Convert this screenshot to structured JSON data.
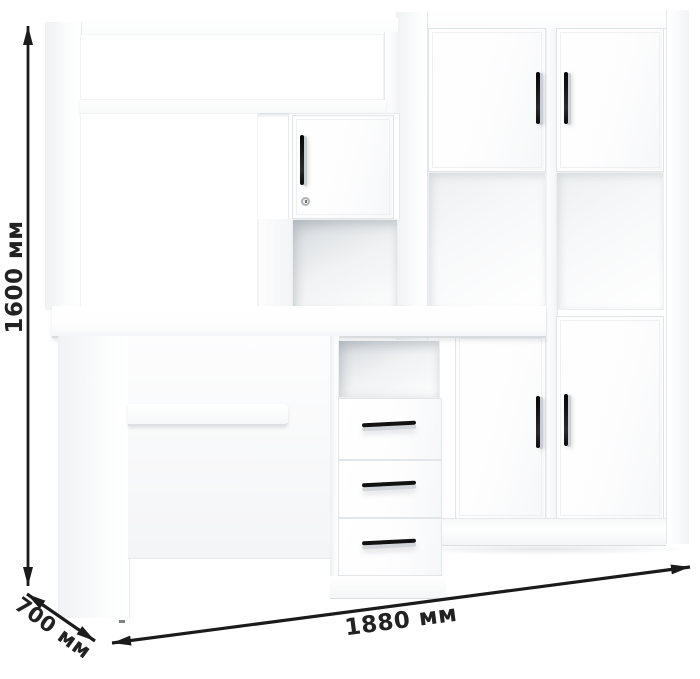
{
  "image": {
    "type": "furniture-dimension-render",
    "background_color": "#ffffff"
  },
  "annotations": {
    "arrow_color": "#1b1b1b",
    "label_color": "#222222",
    "height": {
      "label": "1600 мм"
    },
    "depth": {
      "label": "700 мм"
    },
    "width": {
      "label": "1880 мм"
    }
  },
  "furniture": {
    "finish_color": "#ffffff",
    "handle_color": "#141414",
    "hutch": {
      "doors": 1,
      "open_shelves": 3,
      "has_keyhole": true
    },
    "wall_cabinet": {
      "top_doors": 2,
      "open_shelves": 2,
      "bottom_doors": 2
    },
    "desk": {
      "drawers": 3,
      "has_keyboard_shelf": true
    }
  }
}
